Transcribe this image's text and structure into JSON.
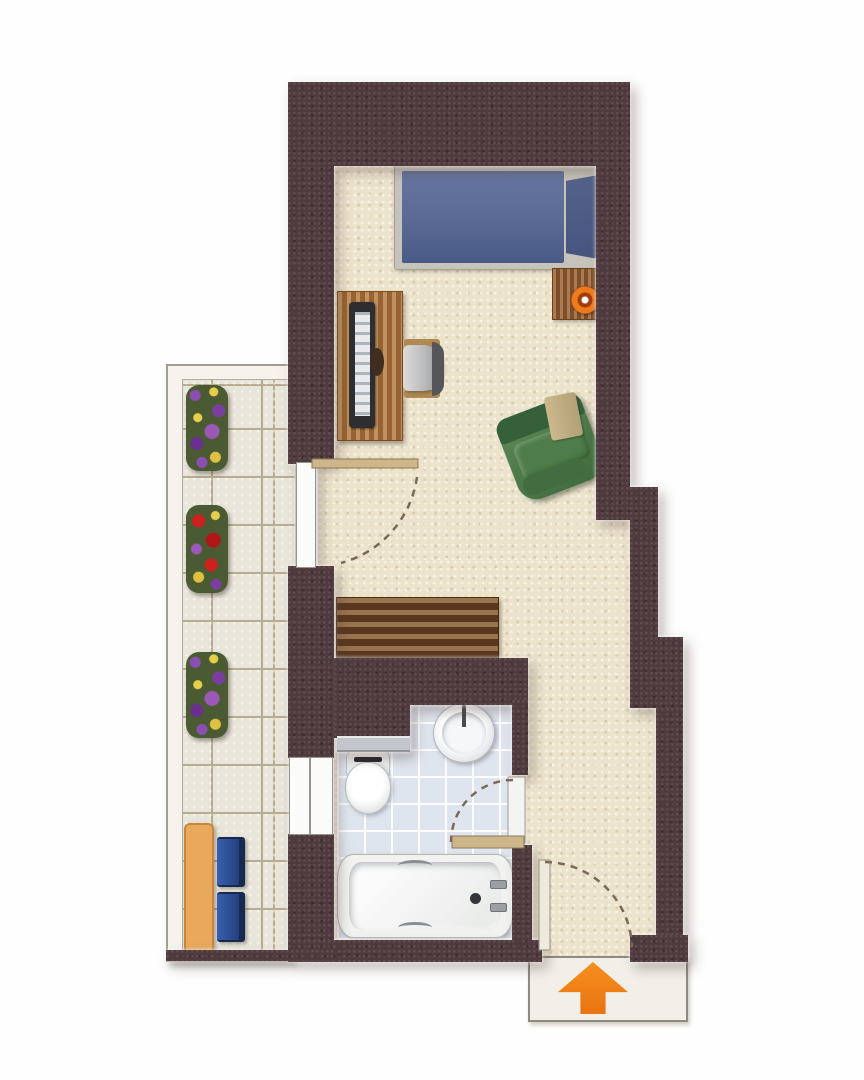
{
  "floorplan": {
    "view": "top-down apartment floor plan",
    "rooms": [
      {
        "id": "main-room",
        "label": "main room",
        "furniture": [
          "bed",
          "pillow",
          "nightstand",
          "table-lamp",
          "desk",
          "monitor",
          "office-chair",
          "armchair",
          "sideboard"
        ]
      },
      {
        "id": "bathroom",
        "label": "bathroom",
        "furniture": [
          "sink",
          "faucet",
          "toilet",
          "bathtub"
        ]
      },
      {
        "id": "balcony",
        "label": "balcony",
        "furniture": [
          "flower-box",
          "flower-box",
          "flower-box",
          "balcony-table",
          "balcony-chair",
          "balcony-chair"
        ]
      },
      {
        "id": "entry-hall",
        "label": "entry hall",
        "furniture": []
      }
    ],
    "doors": [
      {
        "id": "balcony-door",
        "swing": "dashed-arc"
      },
      {
        "id": "bathroom-door",
        "swing": "dashed-arc"
      },
      {
        "id": "entrance-door",
        "swing": "dashed-arc"
      }
    ],
    "entrance_marker": {
      "symbol": "up-arrow",
      "direction": "up",
      "color": "#ee8018"
    },
    "palette": {
      "wall": "#4f3a3e",
      "floor": "#ece3cb",
      "balcony_tile": "#e8e5da",
      "bathroom_tile": "#dfe5ee",
      "bed_blue": "#5a6a95",
      "pillow_blue": "#4d5b82",
      "wood_desk": "#a76f39",
      "wood_sideboard": "#6e4526",
      "armchair_green": "#4e7d49",
      "balcony_chair_blue": "#2f55a4",
      "balcony_table_orange": "#e9a95c",
      "door_swing_dash": "#7a6a55",
      "arrow_orange": "#ee8018"
    }
  }
}
